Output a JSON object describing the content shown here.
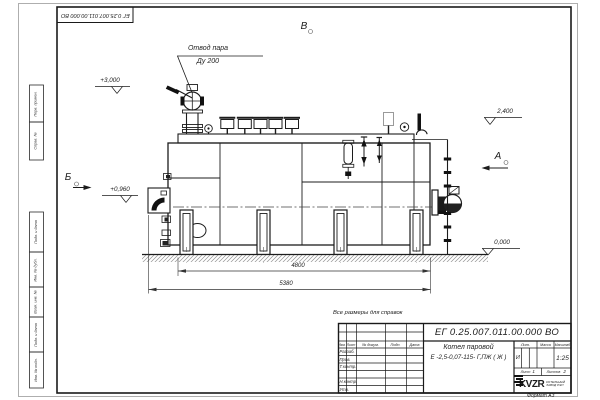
{
  "sheet": {
    "corner_designation": "ЕГ 0.25.007.011.00.000  ВО",
    "format_note": "Формат А3",
    "margin_stamps": [
      "Перв. примен.",
      "Справ. №",
      "Подп. и дата",
      "Инв. № дубл.",
      "Взам. инв. №",
      "Подп. и дата",
      "Инв. № подл."
    ]
  },
  "drawing": {
    "callout": {
      "line1": "Отвод пара",
      "line2": "Ду 200"
    },
    "views": {
      "a": "А",
      "b": "Б",
      "v": "В"
    },
    "elevations": {
      "e3000": "+3,000",
      "e0960": "+0,960",
      "e2400": "2,400",
      "e0000": "0,000"
    },
    "dimensions": {
      "d4800": "4800",
      "d5380": "5380"
    }
  },
  "title_block": {
    "note": "Все размеры для справок",
    "designation": "ЕГ 0.25.007.011.00.000  ВО",
    "name1": "Котел паровой",
    "name2": "Е -2,5-0,07-115- Г,ПЖ ( Ж )",
    "col_izm": "Изм.",
    "col_list": "Лист",
    "col_doc": "№ докум.",
    "col_podp": "Подп.",
    "col_data": "Дата",
    "row_razrab": "Разраб.",
    "row_prov": "Пров.",
    "row_tkontr": "Т.контр.",
    "row_nkontr": "Н.контр.",
    "row_utv": "Утв.",
    "lit_header": "Лит.",
    "mass_header": "Масса",
    "scale_header": "Масштаб",
    "lit_value": "И",
    "scale_value": "1:25",
    "sheet_label": "Лист",
    "sheet_value": "1",
    "sheets_label": "Листов",
    "sheets_value": "2",
    "logo": "KVZR",
    "logo_line1": "КОТЕЛЬНЫЙ",
    "logo_line2": "ЗАВОД РЭП"
  }
}
